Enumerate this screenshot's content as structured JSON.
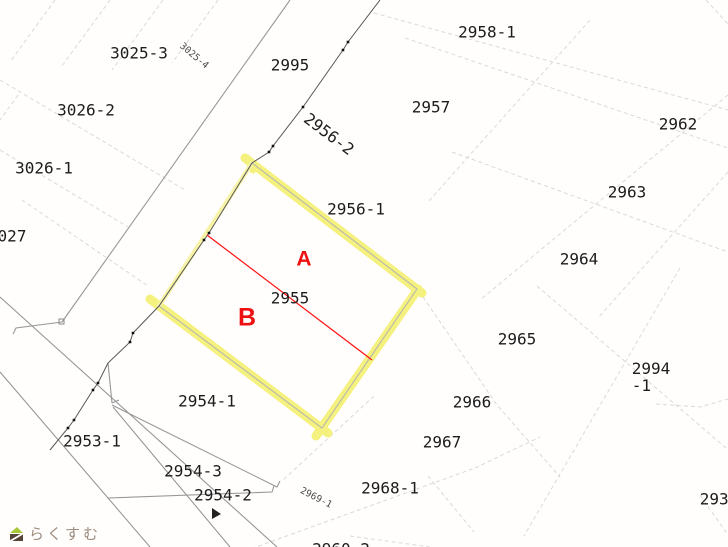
{
  "map": {
    "description": "cadastral parcel map with highlighted lot 2955 split into sections A and B",
    "colors": {
      "highlight": "#f5f075",
      "highlight_light": "#f7f3a0",
      "division_line": "#ff1010",
      "section_text": "#ee1111",
      "parcel_text": "#1c1c1c",
      "line_strong": "#555555",
      "line_mid": "#979797",
      "line_faint": "#d9d9d9",
      "watermark": "#9c8b7e",
      "logo_green": "#a9c837",
      "logo_brown": "#564639"
    },
    "highlighted_parcel": "2955",
    "sections": [
      "A",
      "B"
    ],
    "labels": [
      {
        "text": "3025-3",
        "cx": 139,
        "cy": 53,
        "rot": 0,
        "type": "parcel"
      },
      {
        "text": "3025-4",
        "cx": 194,
        "cy": 56,
        "rot": 40,
        "type": "small"
      },
      {
        "text": "2995",
        "cx": 290,
        "cy": 65,
        "rot": 0,
        "type": "parcel"
      },
      {
        "text": "2958-1",
        "cx": 487,
        "cy": 32,
        "rot": 0,
        "type": "parcel"
      },
      {
        "text": "2957",
        "cx": 431,
        "cy": 107,
        "rot": 0,
        "type": "parcel"
      },
      {
        "text": "2962",
        "cx": 678,
        "cy": 124,
        "rot": 0,
        "type": "parcel"
      },
      {
        "text": "3026-2",
        "cx": 86,
        "cy": 110,
        "rot": 0,
        "type": "parcel"
      },
      {
        "text": "2956-2",
        "cx": 329,
        "cy": 134,
        "rot": 37,
        "type": "parcel"
      },
      {
        "text": "3026-1",
        "cx": 44,
        "cy": 168,
        "rot": 0,
        "type": "parcel"
      },
      {
        "text": "2963",
        "cx": 627,
        "cy": 192,
        "rot": 0,
        "type": "parcel"
      },
      {
        "text": "2956-1",
        "cx": 356,
        "cy": 209,
        "rot": 0,
        "type": "parcel"
      },
      {
        "text": "2964",
        "cx": 579,
        "cy": 259,
        "rot": 0,
        "type": "parcel"
      },
      {
        "text": "027",
        "cx": 12,
        "cy": 236,
        "rot": 0,
        "type": "parcel"
      },
      {
        "text": "A",
        "cx": 304,
        "cy": 259,
        "rot": 0,
        "type": "section",
        "size": 21
      },
      {
        "text": "2955",
        "cx": 290,
        "cy": 298,
        "rot": 0,
        "type": "parcel"
      },
      {
        "text": "B",
        "cx": 247,
        "cy": 318,
        "rot": 0,
        "type": "section",
        "size": 25
      },
      {
        "text": "2965",
        "cx": 517,
        "cy": 339,
        "rot": 0,
        "type": "parcel"
      },
      {
        "text": "2994\n-1",
        "cx": 651,
        "cy": 377,
        "rot": 0,
        "type": "parcel"
      },
      {
        "text": "2954-1",
        "cx": 207,
        "cy": 401,
        "rot": 0,
        "type": "parcel"
      },
      {
        "text": "2966",
        "cx": 472,
        "cy": 402,
        "rot": 0,
        "type": "parcel"
      },
      {
        "text": "2953-1",
        "cx": 92,
        "cy": 441,
        "rot": 0,
        "type": "parcel"
      },
      {
        "text": "2967",
        "cx": 442,
        "cy": 442,
        "rot": 0,
        "type": "parcel"
      },
      {
        "text": "2954-3",
        "cx": 193,
        "cy": 471,
        "rot": 0,
        "type": "parcel"
      },
      {
        "text": "2954-2",
        "cx": 223,
        "cy": 495,
        "rot": 0,
        "type": "parcel"
      },
      {
        "text": "2968-1",
        "cx": 390,
        "cy": 488,
        "rot": 0,
        "type": "parcel"
      },
      {
        "text": "2969-1",
        "cx": 316,
        "cy": 498,
        "rot": 27,
        "type": "small"
      },
      {
        "text": "2937",
        "cx": 719,
        "cy": 499,
        "rot": 0,
        "type": "parcel"
      },
      {
        "text": "2960-2",
        "cx": 341,
        "cy": 549,
        "rot": 0,
        "type": "parcel"
      }
    ],
    "watermark": {
      "text": "らくすむ"
    }
  }
}
